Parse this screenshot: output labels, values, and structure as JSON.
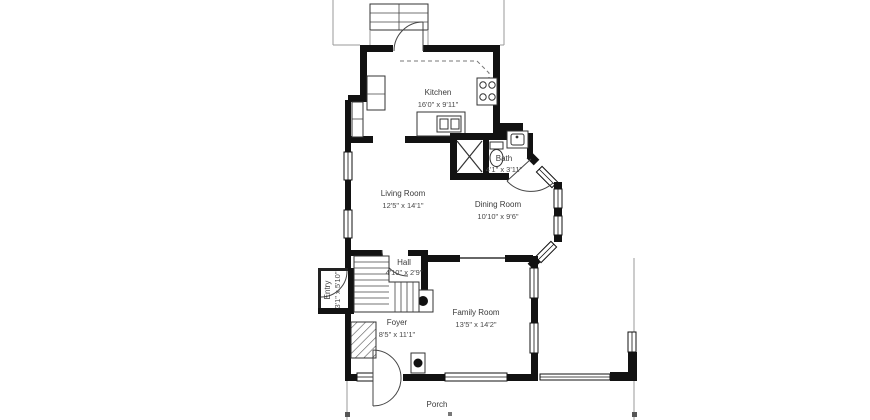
{
  "title": "First floor plan",
  "rooms": {
    "kitchen": {
      "name": "Kitchen",
      "dims": "16'0\" x 9'11\""
    },
    "bath": {
      "name": "Bath",
      "dims": "4'1\" x 3'11\""
    },
    "living_room": {
      "name": "Living Room",
      "dims": "12'5\" x 14'1\""
    },
    "dining_room": {
      "name": "Dining Room",
      "dims": "10'10\" x 9'6\""
    },
    "hall": {
      "name": "Hall",
      "dims": "4'10\" x 2'9\""
    },
    "entry": {
      "name": "Entry",
      "dims": "3'1\" x 5'10\""
    },
    "foyer": {
      "name": "Foyer",
      "dims": "8'5\" x 11'1\""
    },
    "family_room": {
      "name": "Family Room",
      "dims": "13'5\" x 14'2\""
    },
    "porch": {
      "name": "Porch",
      "dims": ""
    }
  },
  "colors": {
    "wall": "#121212",
    "label": "#3a3a3a",
    "background": "#ffffff"
  }
}
